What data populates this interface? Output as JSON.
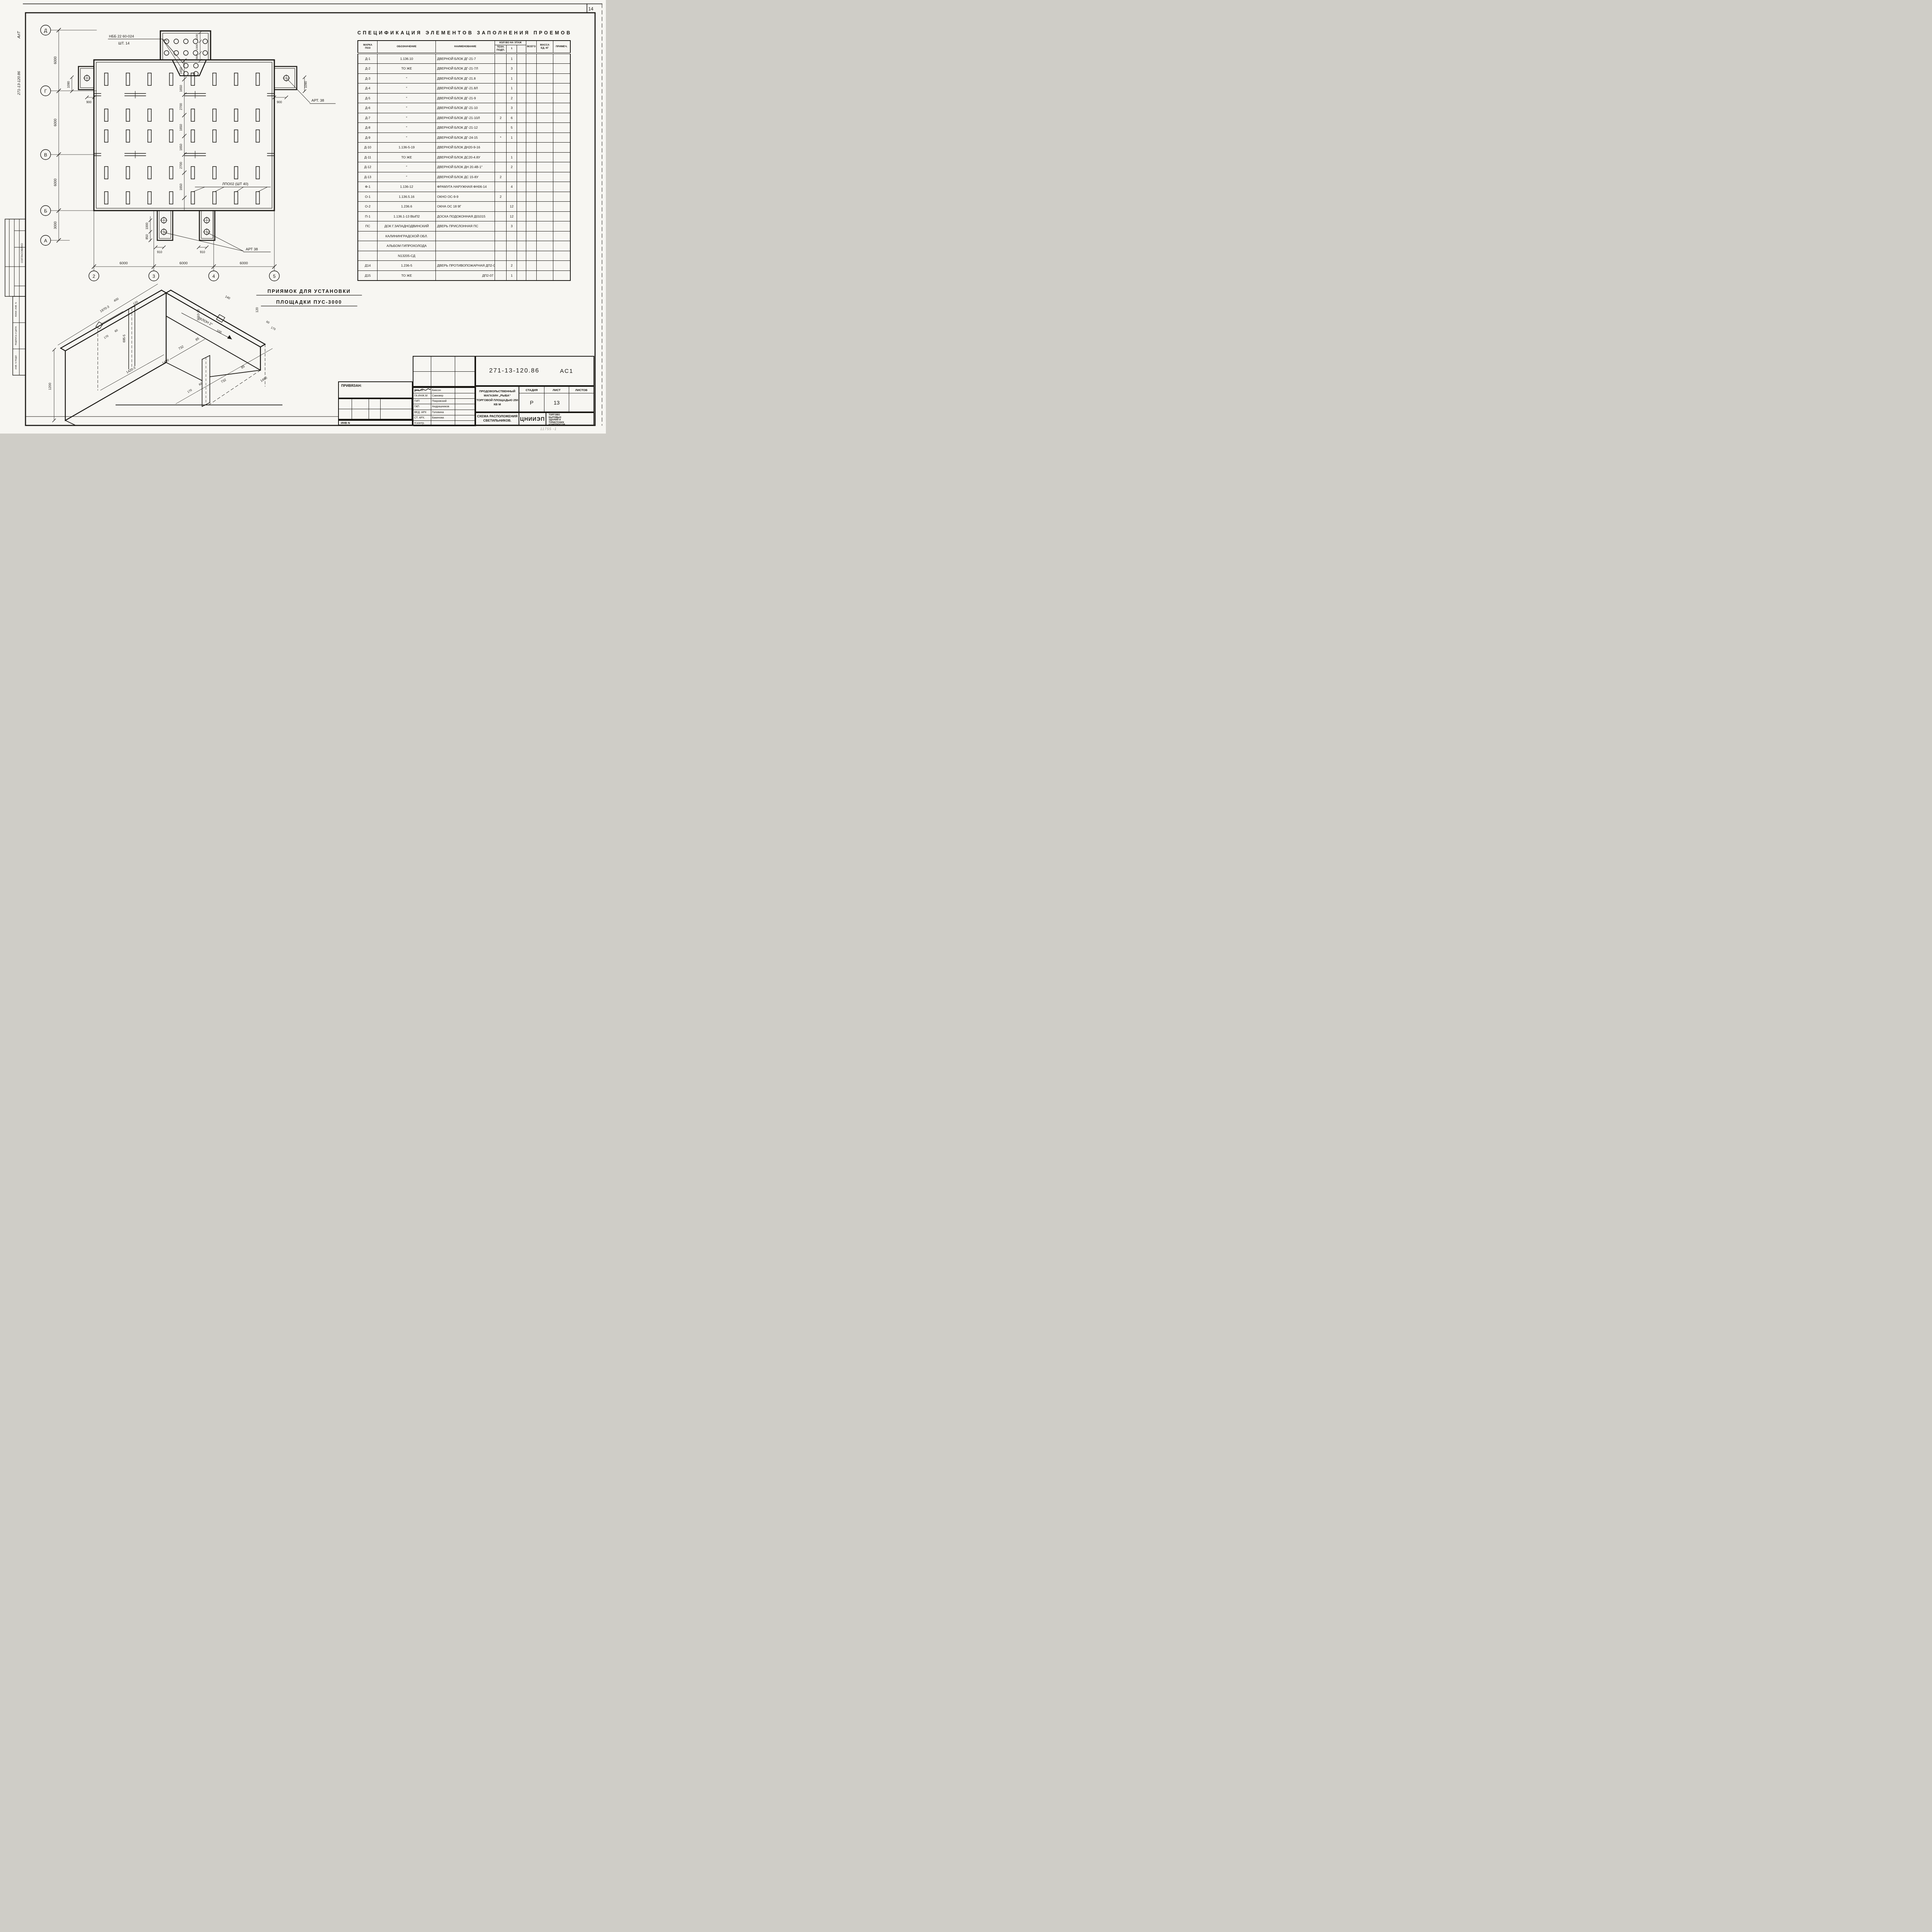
{
  "sheet": {
    "corner_number": "14",
    "faint_note": "11755 -1"
  },
  "margin": {
    "alt": "АлТ",
    "doc_number": "271-13-120.86",
    "soglasovano": "СОГЛАСОВАНО",
    "vzam": "ВЗАМ. ИНВ. N",
    "podpis": "ПОДПИСЬ И ДАТА",
    "inv_podl": "ИНВ. N ПОДЛ."
  },
  "plan": {
    "row_axes": [
      "Д",
      "Г",
      "В",
      "Б",
      "А"
    ],
    "col_axes": [
      "2",
      "3",
      "4",
      "5"
    ],
    "left_dims": [
      "6000",
      "6000",
      "6000",
      "3000"
    ],
    "bottom_dims": [
      "6000",
      "6000",
      "6000"
    ],
    "center_dims": [
      "1650",
      "1650",
      "2700",
      "1650",
      "1650",
      "2700",
      "1650"
    ],
    "vest_dims": [
      "1100",
      "1000",
      "900"
    ],
    "porch_left_v": "1090",
    "porch_left_h": "900",
    "porch_right_v": "1090",
    "porch_right_h": "900",
    "bp_dims": [
      "1000",
      "850"
    ],
    "bp_h": [
      "910",
      "910"
    ],
    "labels": {
      "nbb": "НББ 22 60-024",
      "nbb_qty": "ШТ. 14",
      "lpo": "ЛПО02 (ШТ 40)",
      "art_right": "АРТ. 38",
      "art_bottom": "АРТ 38"
    },
    "lamp_rows": 5,
    "lamp_cols": 8
  },
  "detail": {
    "title1": "ПРИЯМОК ДЛЯ УСТАНОВКИ",
    "title2": "ПЛОЩАДКИ ПУС-3000",
    "dims": {
      "top_edge": "1970-3",
      "height_left": "1200",
      "w400": "400",
      "w120_top": "120",
      "s170_left": "170",
      "s60_left": "60",
      "slot695": "695-5",
      "w140": "140",
      "w120_right": "120",
      "w100": "100",
      "s60_right": "60",
      "s170_right": "170",
      "w732_mid": "732",
      "w85_mid": "85",
      "w1420": "1420-3",
      "w1490_left": "1490",
      "uklon": "УКЛОН 2°",
      "h1010": "1010-20",
      "s170_bot": "170",
      "s60_bot": "60",
      "w732_bot": "732",
      "w85_bot": "85",
      "w1490_bot": "1490"
    }
  },
  "spec_table": {
    "title": "СПЕЦИФИКАЦИЯ  ЭЛЕМЕНТОВ  ЗАПОЛНЕНИЯ  ПРОЕМОВ",
    "headers": {
      "mark": "МАРКА\nПОЗ",
      "designation": "ОБОЗНАЧЕНИЕ",
      "name": "НАИМЕНОВАНИЕ",
      "qty_group": "КОЛ ВО НА ЭТАЖ",
      "tech": "ТЕХН.\nПОДП.",
      "floor1": "1",
      "floor2": "",
      "total": "ВСЕГО",
      "mass": "МАССА\nЕД. КГ",
      "note": "ПРИМЕЧ."
    },
    "rows": [
      {
        "mark": "Д-1",
        "des": "1.136.10",
        "name": "ДВЕРНОЙ БЛОК ДГ-21-7",
        "tech": "",
        "f1": "1"
      },
      {
        "mark": "Д-2",
        "des": "ТО ЖЕ",
        "name": "ДВЕРНОЙ БЛОК ДГ-21-7Л",
        "tech": "",
        "f1": "3"
      },
      {
        "mark": "Д-3",
        "des": "″",
        "name": "ДВЕРНОЙ БЛОК ДГ-21.8",
        "tech": "",
        "f1": "1"
      },
      {
        "mark": "Д-4",
        "des": "″",
        "name": "ДВЕРНОЙ БЛОК ДГ-21.8Л",
        "tech": "",
        "f1": "1"
      },
      {
        "mark": "Д-5",
        "des": "″",
        "name": "ДВЕРНОЙ БЛОК ДГ-21-9",
        "tech": "",
        "f1": "2"
      },
      {
        "mark": "Д-6",
        "des": "″",
        "name": "ДВЕРНОЙ БЛОК ДГ-21-10",
        "tech": "",
        "f1": "3"
      },
      {
        "mark": "Д-7",
        "des": "″",
        "name": "ДВЕРНОЙ БЛОК ДГ-21-10Л",
        "tech": "2",
        "f1": "6"
      },
      {
        "mark": "Д-8",
        "des": "″",
        "name": "ДВЕРНОЙ БЛОК ДГ-21-12",
        "tech": "",
        "f1": "5"
      },
      {
        "mark": "Д-9",
        "des": "″",
        "name": "ДВЕРНОЙ БЛОК ДГ-24-15",
        "tech": "*",
        "f1": "1"
      },
      {
        "mark": "Д-10",
        "des": "1.136-5-19",
        "name": "ДВЕРНОЙ БЛОК ДН20-9-16",
        "tech": "",
        "f1": ""
      },
      {
        "mark": "Д-11",
        "des": "ТО ЖЕ",
        "name": "ДВЕРНОЙ БЛОК ДС20-4.8У",
        "tech": "",
        "f1": "1"
      },
      {
        "mark": "Д-12",
        "des": "″",
        "name": "ДВЕРНОЙ БЛОК ДН 20.4В-1″",
        "tech": "",
        "f1": "2"
      },
      {
        "mark": "Д-13",
        "des": "″",
        "name": "ДВЕРНОЙ БЛОК ДС 15-8У",
        "tech": "2",
        "f1": ""
      },
      {
        "mark": "Ф-1",
        "des": "1.136-12",
        "name": "ФРАМУГА НАРУЖНАЯ ФН06-14",
        "tech": "",
        "f1": "4"
      },
      {
        "mark": "О-1",
        "des": "1.136.5.16",
        "name": "ОКНО ОС-9-9",
        "tech": "2",
        "f1": ""
      },
      {
        "mark": "О-2",
        "des": "1.236.6",
        "name": "ОКНА ОС 18 9Г",
        "tech": "",
        "f1": "12"
      },
      {
        "mark": "П-1",
        "des": "1.136.1-13 ВЫП2",
        "name": "ДОСКА ПОДОКОННАЯ Д01015",
        "tech": "",
        "f1": "12"
      },
      {
        "mark": "ПС",
        "des": "ДОК Г.ЗАПАДНОДВИНСКИЙ",
        "name": "ДВЕРЬ ПРИСЛОННАЯ ПС",
        "tech": "",
        "f1": "3"
      },
      {
        "mark": "",
        "des": "КАЛИНИНГРАДСКОЙ ОБЛ.",
        "name": "",
        "tech": "",
        "f1": ""
      },
      {
        "mark": "",
        "des": "АЛЬБОМ ГИПРОХОЛОДА",
        "name": "",
        "tech": "",
        "f1": ""
      },
      {
        "mark": "",
        "des": "N13205-СД",
        "name": "",
        "tech": "",
        "f1": ""
      },
      {
        "mark": "Д14",
        "des": "1.236-5",
        "name": "ДВЕРЬ ПРОТИВОПОЖАРНАЯ ДП2-07",
        "tech": "",
        "f1": "2"
      },
      {
        "mark": "Д15",
        "des": "ТО ЖЕ",
        "name": "ДП2-07",
        "align": "right",
        "tech": "",
        "f1": "1"
      }
    ]
  },
  "title_block": {
    "doc_number": "271-13-120.86",
    "code": "АС1",
    "roles": [
      {
        "role": "РУК. М.",
        "name": "Биксон"
      },
      {
        "role": "ГА ИНЖ.М",
        "name": "Самовер"
      },
      {
        "role": "ГИП",
        "name": "Покровский"
      },
      {
        "role": "ГАП",
        "name": "Андрашников"
      },
      {
        "role": "ВЕД. АРХ",
        "name": "Головина"
      },
      {
        "role": "СТ. АРХ.",
        "name": "Бакинова"
      },
      {
        "role": "Н.контр.",
        "name": ""
      }
    ],
    "project_line1": "ПРОДОВОЛЬСТВЕННЫЙ",
    "project_line2": "МАГАЗИН „РЫБА“",
    "project_line3": "ТОРГОВОЙ ПЛОЩАДЬЮ 250 КВ М",
    "stage_h": "СТАДИЯ",
    "sheet_h": "ЛИСТ",
    "sheets_h": "ЛИСТОВ",
    "stage": "Р",
    "sheet": "13",
    "sheets": "",
    "title_line1": "СХЕМА РАСПОЛОЖЕНИЯ",
    "title_line2": "СВЕТИЛЬНИКОВ.",
    "org": "ЦНИИЭП",
    "org_line1": "ТОРГОВО",
    "org_line2": "БЫТОВЫХ",
    "org_line3": "ЗДАНИЙ И",
    "org_line4": "ТУРИСТСКИХ",
    "org_line5": "КОМПЛЕКСОВ",
    "privyazan": "ПРИВЯЗАН:",
    "inv_n": "ИНВ N"
  }
}
